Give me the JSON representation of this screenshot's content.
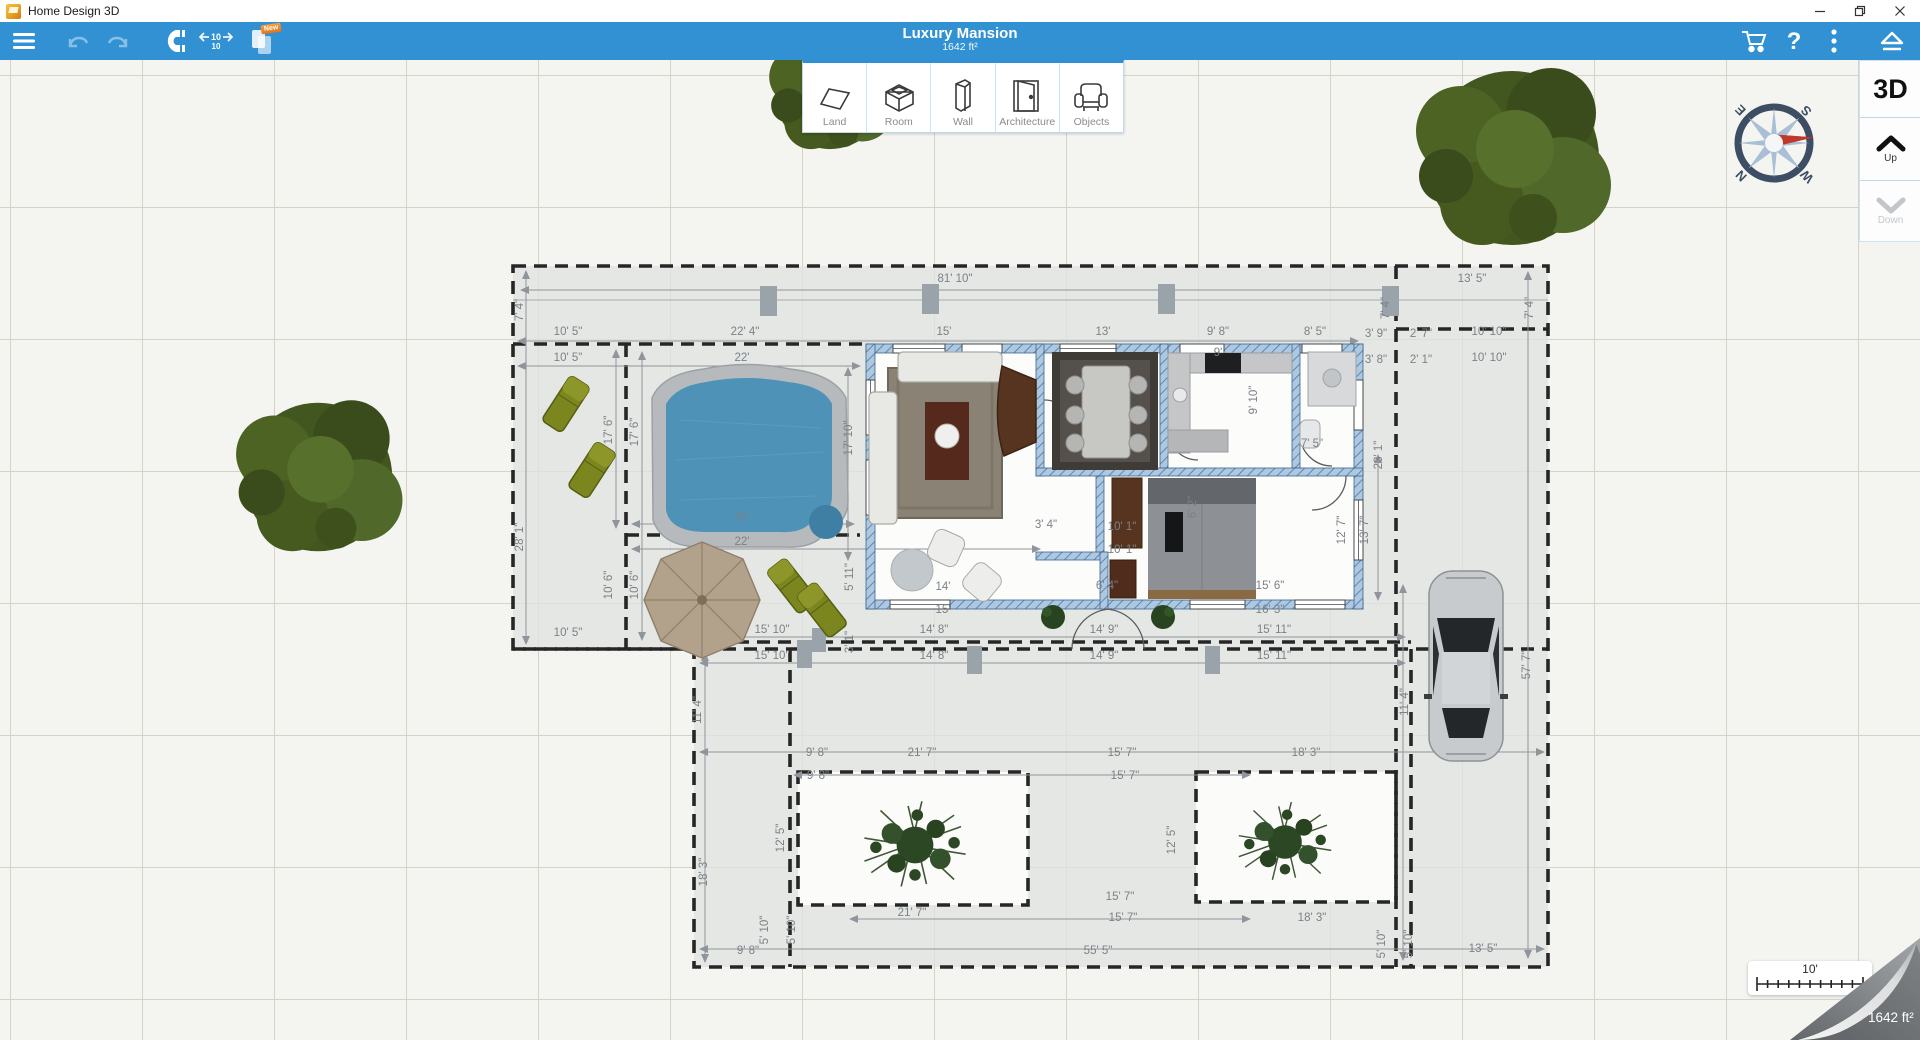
{
  "window": {
    "title": "Home Design 3D"
  },
  "toolbar": {
    "title": "Luxury Mansion",
    "subtitle": "1642 ft²",
    "measure_badge_top": "10",
    "measure_badge_bottom": "10",
    "new_badge": "New"
  },
  "tools": {
    "items": [
      {
        "label": "Land"
      },
      {
        "label": "Room"
      },
      {
        "label": "Wall"
      },
      {
        "label": "Architecture"
      },
      {
        "label": "Objects"
      }
    ]
  },
  "right_panel": {
    "view3d": "3D",
    "up": "Up",
    "down": "Down"
  },
  "compass": {
    "n": "N",
    "e": "E",
    "s": "S",
    "w": "W"
  },
  "scale_bar": {
    "label": "10'"
  },
  "corner": {
    "area": "1642 ft²"
  },
  "plan": {
    "accent_blue": "#3191d3",
    "wall_color": "#adc8e0",
    "pool_water": "#4e93b7",
    "dimensions": [
      {
        "t": "81' 10\"",
        "x": 955,
        "y": 282
      },
      {
        "t": "13' 5\"",
        "x": 1472,
        "y": 282
      },
      {
        "t": "7' 4\"",
        "x": 523,
        "y": 310,
        "r": -90
      },
      {
        "t": "7' 4\"",
        "x": 1389,
        "y": 308,
        "r": -90
      },
      {
        "t": "7' 4\"",
        "x": 1533,
        "y": 308,
        "r": -90
      },
      {
        "t": "10' 5\"",
        "x": 568,
        "y": 335
      },
      {
        "t": "22' 4\"",
        "x": 745,
        "y": 335
      },
      {
        "t": "15'",
        "x": 944,
        "y": 335
      },
      {
        "t": "13'",
        "x": 1103,
        "y": 335
      },
      {
        "t": "9' 8\"",
        "x": 1218,
        "y": 335
      },
      {
        "t": "8' 5\"",
        "x": 1315,
        "y": 335
      },
      {
        "t": "3' 9\"",
        "x": 1376,
        "y": 337
      },
      {
        "t": "2' 7\"",
        "x": 1421,
        "y": 337
      },
      {
        "t": "10' 10\"",
        "x": 1489,
        "y": 335
      },
      {
        "t": "10' 5\"",
        "x": 568,
        "y": 361
      },
      {
        "t": "22'",
        "x": 742,
        "y": 361
      },
      {
        "t": "3' 8\"",
        "x": 1376,
        "y": 363
      },
      {
        "t": "2' 1\"",
        "x": 1421,
        "y": 363
      },
      {
        "t": "10' 10\"",
        "x": 1489,
        "y": 361
      },
      {
        "t": "28' 1\"",
        "x": 523,
        "y": 537,
        "r": -90
      },
      {
        "t": "17' 6\"",
        "x": 612,
        "y": 430,
        "r": -90
      },
      {
        "t": "17' 6\"",
        "x": 638,
        "y": 432,
        "r": -90
      },
      {
        "t": "17' 10\"",
        "x": 852,
        "y": 438,
        "r": -90
      },
      {
        "t": "22'",
        "x": 742,
        "y": 520
      },
      {
        "t": "22'",
        "x": 742,
        "y": 545
      },
      {
        "t": "10' 6\"",
        "x": 612,
        "y": 585,
        "r": -90
      },
      {
        "t": "10' 6\"",
        "x": 638,
        "y": 585,
        "r": -90
      },
      {
        "t": "10' 5\"",
        "x": 568,
        "y": 636
      },
      {
        "t": "15' 10\"",
        "x": 772,
        "y": 633
      },
      {
        "t": "15' 10\"",
        "x": 772,
        "y": 659
      },
      {
        "t": "5' 11\"",
        "x": 853,
        "y": 577,
        "r": -90
      },
      {
        "t": "3' 1\"",
        "x": 853,
        "y": 642,
        "r": -90
      },
      {
        "t": "9'",
        "x": 1218,
        "y": 356
      },
      {
        "t": "9' 10\"",
        "x": 1257,
        "y": 400,
        "r": -90
      },
      {
        "t": "7' 5\"",
        "x": 1312,
        "y": 447
      },
      {
        "t": "23' 1\"",
        "x": 1382,
        "y": 455,
        "r": -90
      },
      {
        "t": "10' 1\"",
        "x": 1122,
        "y": 530
      },
      {
        "t": "10' 1\"",
        "x": 1122,
        "y": 553
      },
      {
        "t": "3' 4\"",
        "x": 1046,
        "y": 528
      },
      {
        "t": "6' 4\"",
        "x": 1107,
        "y": 589
      },
      {
        "t": "14'",
        "x": 943,
        "y": 590
      },
      {
        "t": "15'",
        "x": 943,
        "y": 613
      },
      {
        "t": "12' 7\"",
        "x": 1345,
        "y": 530,
        "r": -90
      },
      {
        "t": "13' 7\"",
        "x": 1368,
        "y": 530,
        "r": -90
      },
      {
        "t": "6' 2\"",
        "x": 1196,
        "y": 507,
        "r": -90
      },
      {
        "t": "15' 6\"",
        "x": 1270,
        "y": 589
      },
      {
        "t": "16' 3\"",
        "x": 1270,
        "y": 613
      },
      {
        "t": "14' 8\"",
        "x": 934,
        "y": 633
      },
      {
        "t": "14' 9\"",
        "x": 1104,
        "y": 633
      },
      {
        "t": "15' 11\"",
        "x": 1274,
        "y": 633
      },
      {
        "t": "14' 8\"",
        "x": 934,
        "y": 659
      },
      {
        "t": "14' 9\"",
        "x": 1104,
        "y": 659
      },
      {
        "t": "15' 11\"",
        "x": 1274,
        "y": 659
      },
      {
        "t": "11' 4\"",
        "x": 701,
        "y": 710,
        "r": -90
      },
      {
        "t": "9' 8\"",
        "x": 817,
        "y": 756
      },
      {
        "t": "21' 7\"",
        "x": 922,
        "y": 756
      },
      {
        "t": "15' 7\"",
        "x": 1122,
        "y": 756
      },
      {
        "t": "18' 3\"",
        "x": 1306,
        "y": 756
      },
      {
        "t": "9' 8\"",
        "x": 818,
        "y": 779
      },
      {
        "t": "15' 7\"",
        "x": 1125,
        "y": 779
      },
      {
        "t": "12' 5\"",
        "x": 784,
        "y": 838,
        "r": -90
      },
      {
        "t": "12' 5\"",
        "x": 1175,
        "y": 840,
        "r": -90
      },
      {
        "t": "18' 3\"",
        "x": 707,
        "y": 872,
        "r": -90
      },
      {
        "t": "15' 7\"",
        "x": 1120,
        "y": 900
      },
      {
        "t": "21' 7\"",
        "x": 912,
        "y": 916
      },
      {
        "t": "15' 7\"",
        "x": 1123,
        "y": 921
      },
      {
        "t": "18' 3\"",
        "x": 1312,
        "y": 921
      },
      {
        "t": "5' 10\"",
        "x": 768,
        "y": 930,
        "r": -90
      },
      {
        "t": "5' 10\"",
        "x": 795,
        "y": 930,
        "r": -90
      },
      {
        "t": "9' 8\"",
        "x": 748,
        "y": 954
      },
      {
        "t": "55' 5\"",
        "x": 1098,
        "y": 954
      },
      {
        "t": "13' 5\"",
        "x": 1483,
        "y": 952
      },
      {
        "t": "5' 10\"",
        "x": 1385,
        "y": 944,
        "r": -90
      },
      {
        "t": "5' 10\"",
        "x": 1412,
        "y": 944,
        "r": -90
      },
      {
        "t": "57' 7\"",
        "x": 1530,
        "y": 665,
        "r": -90
      },
      {
        "t": "11' 4\"",
        "x": 1408,
        "y": 702,
        "r": -90
      }
    ]
  }
}
